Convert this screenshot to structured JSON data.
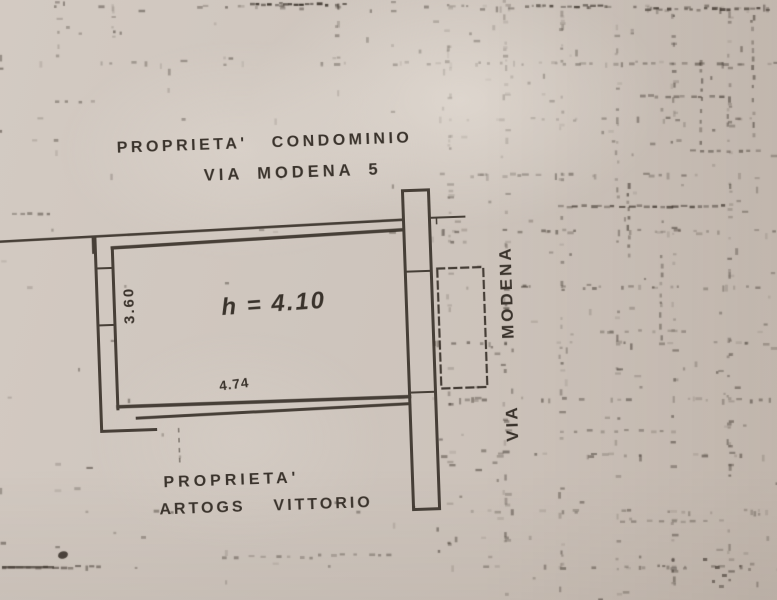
{
  "plan": {
    "top_property_label": "PROPRIETA'",
    "top_property_owner": "CONDOMINIO",
    "top_address": "VIA MODENA 5",
    "room_height_label": "h = 4.10",
    "room_width_dim": "4.74",
    "room_depth_dim": "3.60",
    "street_vertical_upper": "MODENA",
    "street_vertical_lower": "VIA",
    "bottom_property_label": "PROPRIETA'",
    "bottom_owner_surname": "ARTOGS",
    "bottom_owner_firstname": "VITTORIO"
  },
  "colors": {
    "paper": "#cfc6be",
    "ink": "#3b342c"
  }
}
